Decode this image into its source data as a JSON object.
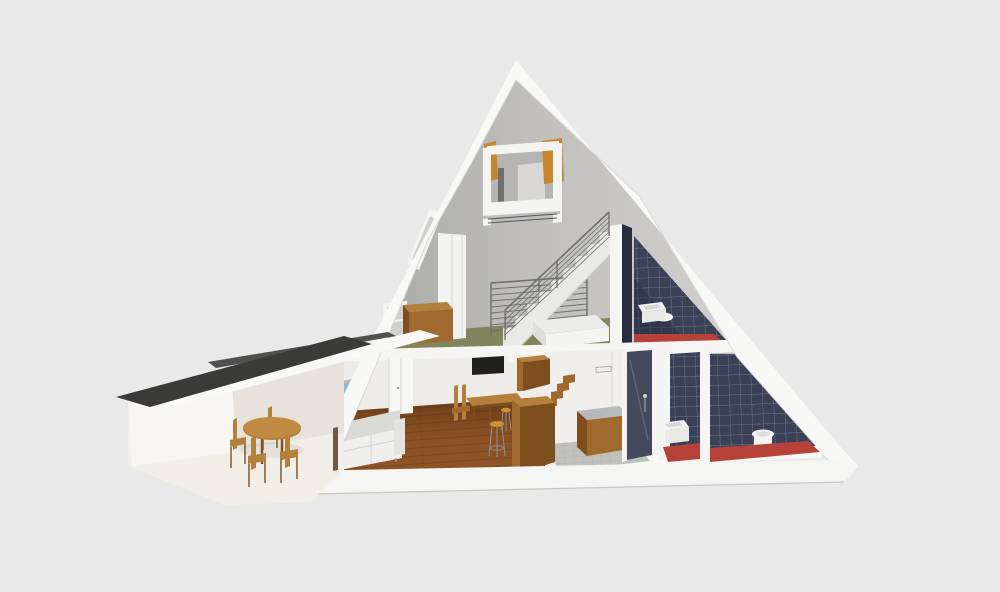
{
  "meta": {
    "description": "3D cutaway section render of an A-frame house with sleeping loft, upper bedroom with green floor and navy tiled bathroom, ground floor living room with wooden floor, kitchen, shower, WC and bathroom with red floors, plus a low annex wing with a dark flat roof and a round wooden dining table with four chairs"
  },
  "colors": {
    "bg": "#e9e9e9",
    "roofWhite": "#f8f8f7",
    "roofEdge": "#d9d9d7",
    "gableDark": "#a4a4a2",
    "gableMid": "#c2c1bf",
    "gableLight": "#d9d8d6",
    "slab": "#f5f5f3",
    "slabShadow": "#c7c7c5",
    "white": "#f4f4f2",
    "wallWhite": "#edece8",
    "loftWood": "#c5862e",
    "floorGreen": "#82855c",
    "floorWood": "#8e5426",
    "woodLine": "#5f3514",
    "floorRed": "#b6423a",
    "tileNavy": "#3a4157",
    "tileNavyDark": "#272d3f",
    "grout": "#8b94ad",
    "showerDark": "#434a5c",
    "counterTop": "#b7babd",
    "woodFurniture": "#b5803c",
    "woodMid": "#a06a2e",
    "woodDark": "#7d4f1f",
    "sofa": "#efefed",
    "sofaShade": "#d9d9d6",
    "tvDark": "#20201f",
    "pictureSky": "#8fb6d6",
    "pictureLand": "#cfc6b0",
    "stoolSeat": "#c9952f",
    "metal": "#8e8e8c",
    "kitchenFloor": "#c2c2bd",
    "kitchenGrid": "#a9a9a4",
    "annexRoof": "#3a3a38",
    "annexWall": "#f8f6f2",
    "annexFloor": "#f2efe9",
    "annexShade": "#e7e3dc",
    "doorWhite": "#f7f7f5",
    "doorSeam": "#6b5a4a",
    "railing": "#6f6f6d",
    "stairTread": "#e9e9e7"
  },
  "scene": {
    "type": "architectural cutaway 3D render",
    "building": "A-frame house cross-section",
    "levels": [
      {
        "name": "loft",
        "rooms": [
          {
            "name": "sleeping loft",
            "features": [
              "suspended white frame",
              "timber posts",
              "bed platform",
              "guard rail"
            ]
          }
        ]
      },
      {
        "name": "upper floor",
        "rooms": [
          {
            "name": "bedroom",
            "floor": "sage green",
            "furniture": [
              "double bed",
              "wooden desk",
              "white shelf",
              "skylight",
              "stair to loft",
              "stairwell railing"
            ]
          },
          {
            "name": "bathroom",
            "floor": "red",
            "walls": "navy tiles",
            "furniture": [
              "wall sink",
              "toilet"
            ]
          }
        ]
      },
      {
        "name": "ground floor",
        "rooms": [
          {
            "name": "living room",
            "floor": "wood planks",
            "furniture": [
              "white sofa",
              "framed picture",
              "wall TV",
              "double door",
              "work table",
              "bench",
              "bar stools"
            ]
          },
          {
            "name": "kitchen",
            "floor": "grey tiles",
            "furniture": [
              "hanging cabinet",
              "island unit",
              "counter with sink",
              "internal stair"
            ]
          },
          {
            "name": "shower room",
            "walls": "dark tiles",
            "furniture": [
              "shower"
            ]
          },
          {
            "name": "wc",
            "floor": "red",
            "walls": "navy tiles",
            "furniture": [
              "wall sink"
            ]
          },
          {
            "name": "bathroom",
            "floor": "red",
            "walls": "navy tiles",
            "furniture": [
              "wall-hung toilet"
            ]
          }
        ]
      },
      {
        "name": "annex wing",
        "rooms": [
          {
            "name": "dining area",
            "roof": "dark flat roof",
            "furniture": [
              "oval wooden table",
              "four wooden chairs"
            ]
          }
        ]
      }
    ]
  }
}
